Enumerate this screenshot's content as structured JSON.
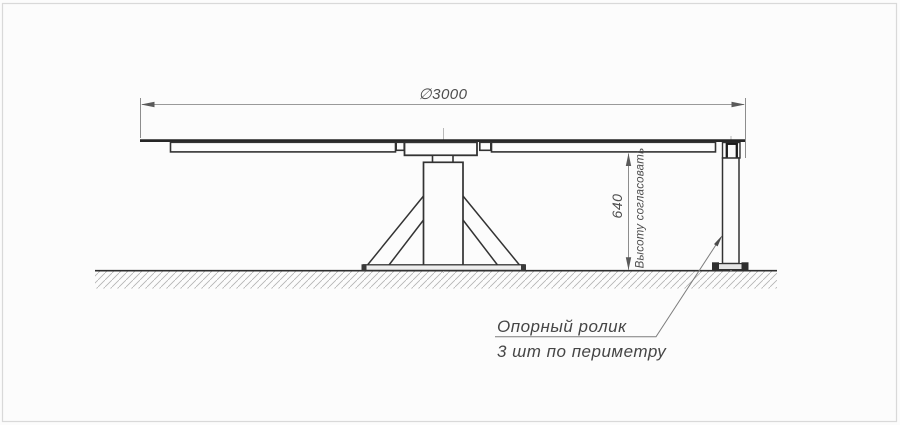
{
  "drawing": {
    "type": "engineering side view of rotary platform on pedestal with support roller",
    "colors": {
      "ink": "#2e2e2e",
      "dim_line": "#8d8d8d",
      "centerline": "#b9b9b9",
      "hatch": "#b3b3b3",
      "background": "#fcfcfc",
      "frame": "#d9d9d9"
    },
    "dimensions": {
      "diameter_label": "∅3000",
      "height_value": "640",
      "height_note": "Высоту согласовать"
    },
    "callout": {
      "line1": "Опорный ролик",
      "line2": "3 шт по периметру"
    }
  }
}
